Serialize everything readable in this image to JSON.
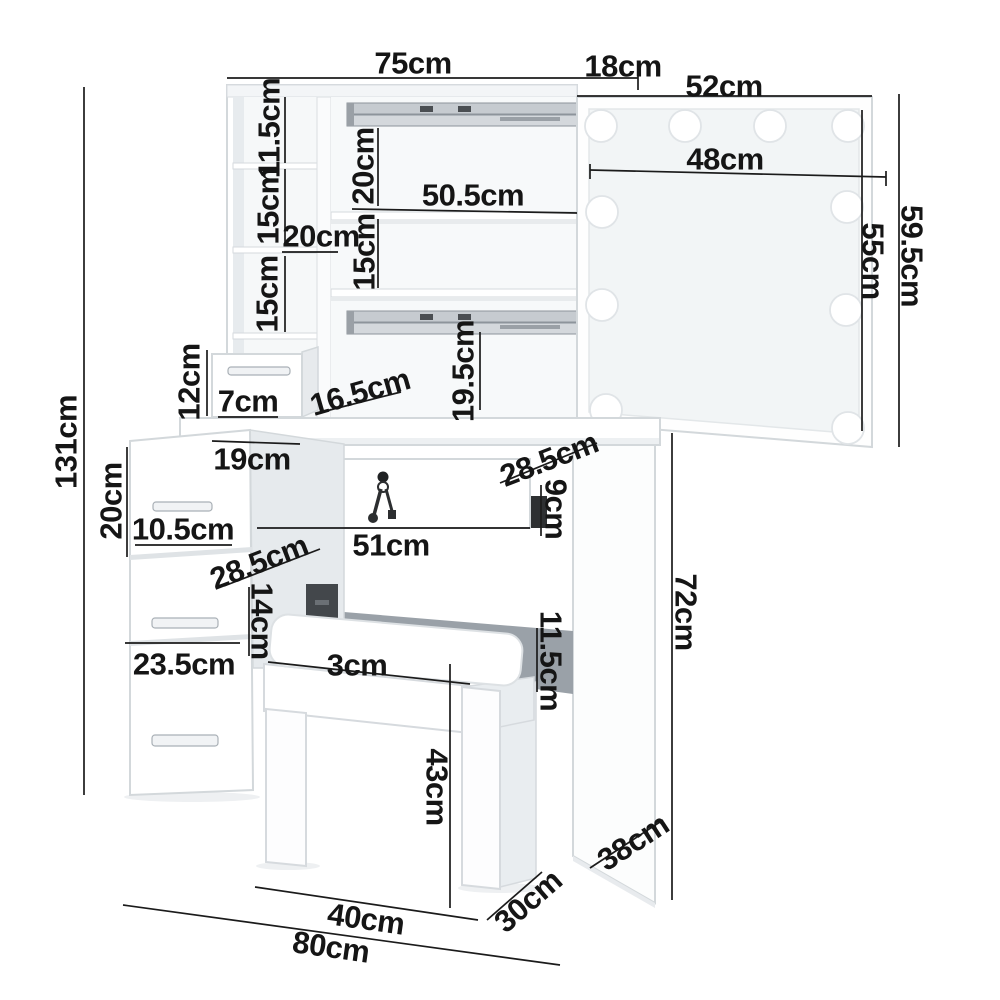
{
  "diagram_type": "furniture-dimension-diagram",
  "product": "dressing table with hollywood mirror, drawers and stool",
  "unit": "cm",
  "dims": {
    "top_width": "75cm",
    "mirror_offset": "18cm",
    "mirror_width": "52cm",
    "mirror_glass_width": "48cm",
    "mirror_height": "59.5cm",
    "mirror_glass_height": "55cm",
    "overall_height": "131cm",
    "cubby_top_height": "11.5cm",
    "cubby_middle_height": "15cm",
    "shelf_depth": "20cm",
    "cubby_bottom_height": "15cm",
    "hutch_upper_opening": "20cm",
    "hutch_lower_opening": "15cm",
    "hutch_inner_width": "50.5cm",
    "hutch_base_opening": "19.5cm",
    "small_drawer_height": "12cm",
    "small_drawer_width": "7cm",
    "small_drawer_depth": "16.5cm",
    "side_gap": "19cm",
    "tabletop_depth": "28.5cm",
    "main_drawer_side": "9cm",
    "main_drawer_width": "51cm",
    "pedestal_drawer_height": "20cm",
    "pedestal_drawer_face": "10.5cm",
    "pedestal_depth": "28.5cm",
    "pedestal_gap": "14cm",
    "bottom_drawer_height": "23.5cm",
    "cushion_height": "3cm",
    "under_desk_gap": "11.5cm",
    "desk_height": "72cm",
    "stool_height": "43cm",
    "stool_width": "40cm",
    "overall_width": "80cm",
    "stool_depth": "30cm",
    "panel_depth": "38cm"
  },
  "colors": {
    "line": "#1b1b1b",
    "edge": "#d3d8db",
    "shade": "#e7ebee",
    "metal": "#c6cbd0",
    "shadow": "#9aa1a8",
    "hardware": "#2c2e30"
  }
}
